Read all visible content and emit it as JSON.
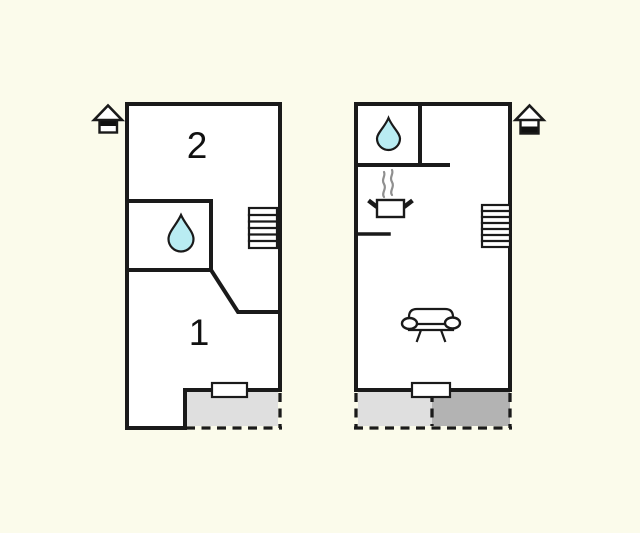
{
  "canvas": {
    "width": 640,
    "height": 533,
    "background": "#fbfbeb"
  },
  "colors": {
    "wall": "#1a1a1a",
    "room_fill": "#ffffff",
    "water_drop": "#b9ecf2",
    "terrace_light": "#dfdfdf",
    "terrace_dark": "#b3b3b3",
    "steam": "#8f8f8f"
  },
  "plan_left": {
    "rooms": [
      {
        "label": "2"
      },
      {
        "label": "1"
      }
    ],
    "icons": {
      "level": "house-upper-level-icon",
      "bath": "water-drop-icon",
      "stairs": "stairs-icon",
      "window": "window-icon",
      "terrace": "terrace-dashed-area"
    }
  },
  "plan_right": {
    "icons": {
      "level": "house-ground-level-icon",
      "bath": "water-drop-icon",
      "cooker": "cooker-icon",
      "stairs": "stairs-icon",
      "sofa": "sofa-icon",
      "window": "window-icon",
      "terrace_light": "terrace-dashed-area-light",
      "terrace_dark": "terrace-dashed-area-dark"
    }
  }
}
